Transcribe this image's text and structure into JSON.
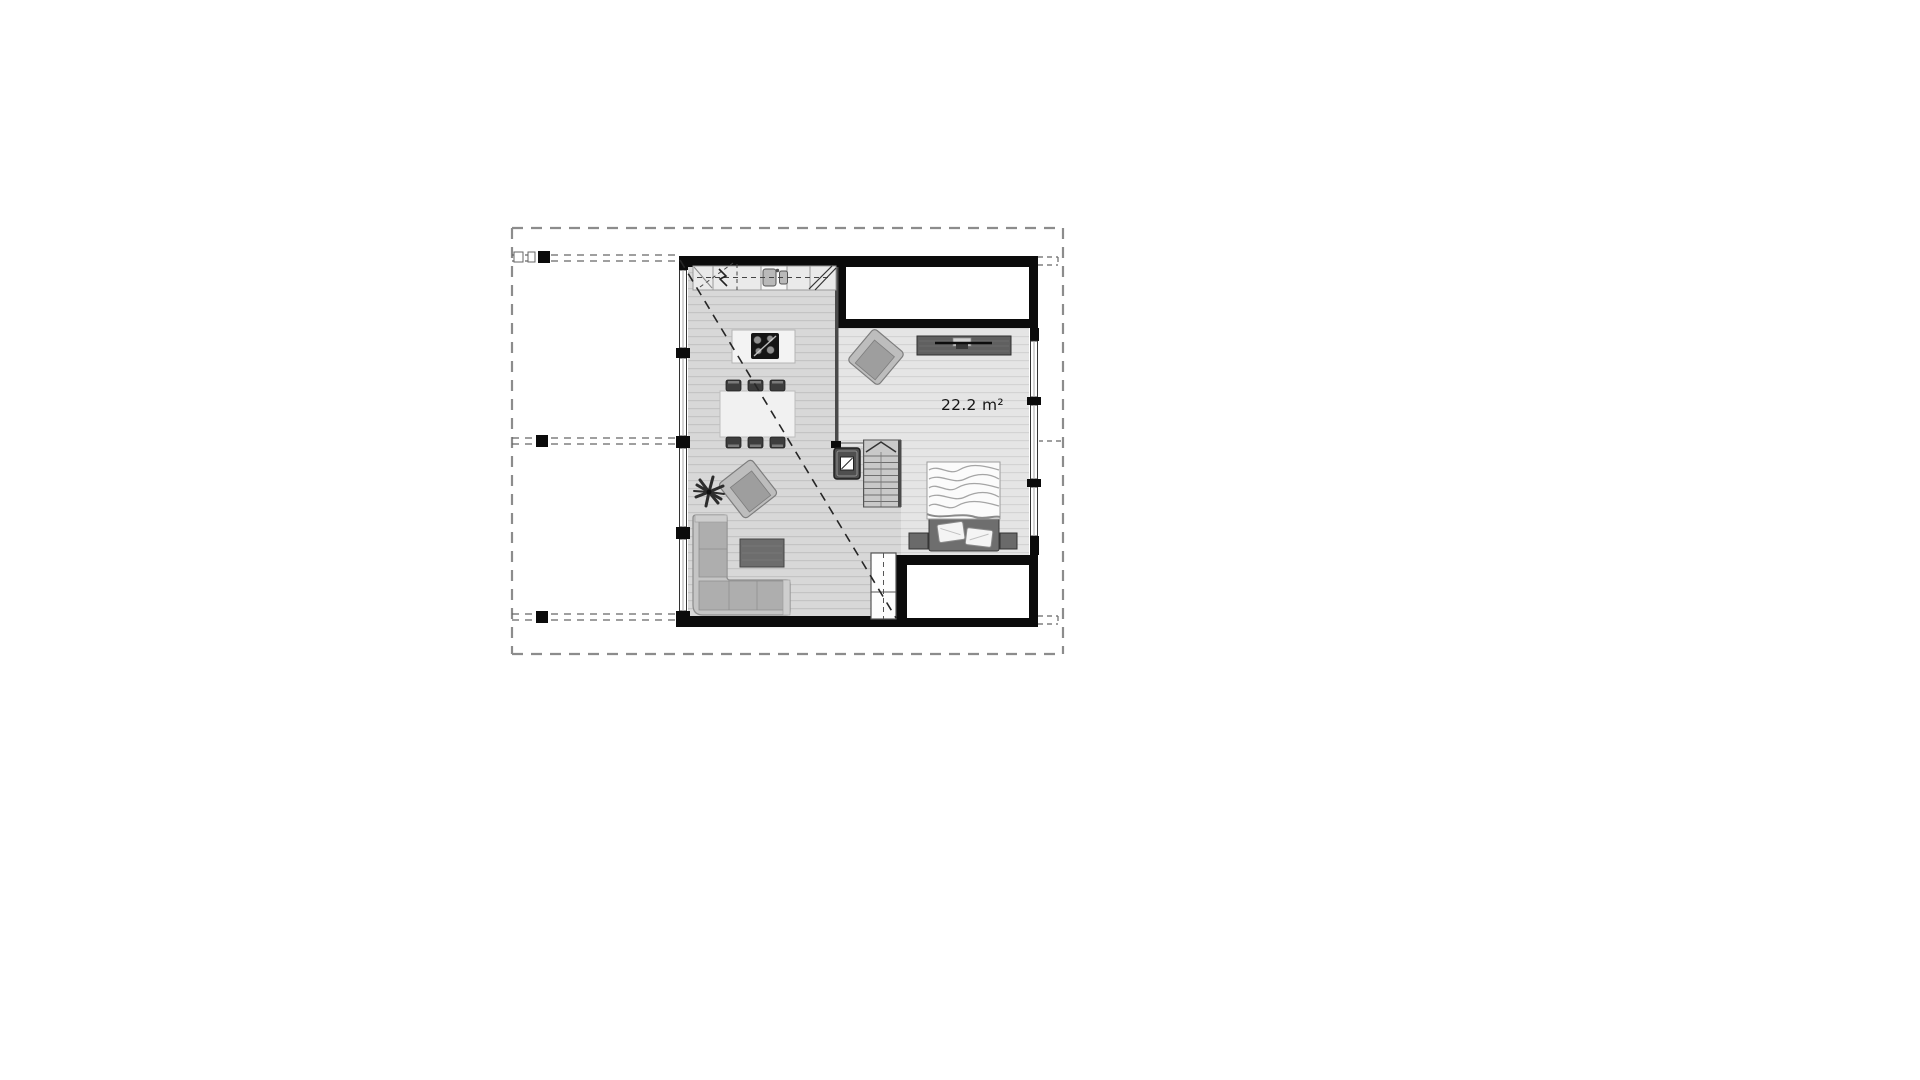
{
  "plan": {
    "area_label": "22.2 m²",
    "colors": {
      "paper": "#ffffff",
      "wall": "#0b0b0b",
      "boundary": "#8c8c8c",
      "living_floor": "#d8d8d8",
      "bedroom_floor": "#e5e5e5",
      "furniture_light": "#c5c5c5",
      "furniture_dark": "#646464",
      "annotation": "#262626"
    },
    "furniture_icons": [
      "kitchen-counter-double-sink",
      "cooktop-island",
      "dining-table-six-chairs",
      "l-shaped-sofa",
      "coffee-table",
      "potted-plant",
      "lounge-armchair-living",
      "wood-stove",
      "staircase-up-arrow",
      "under-stair-cabinet",
      "tv-sideboard",
      "lounge-armchair-bedroom",
      "double-bed-two-pillows",
      "nightstand-left",
      "nightstand-right"
    ]
  }
}
